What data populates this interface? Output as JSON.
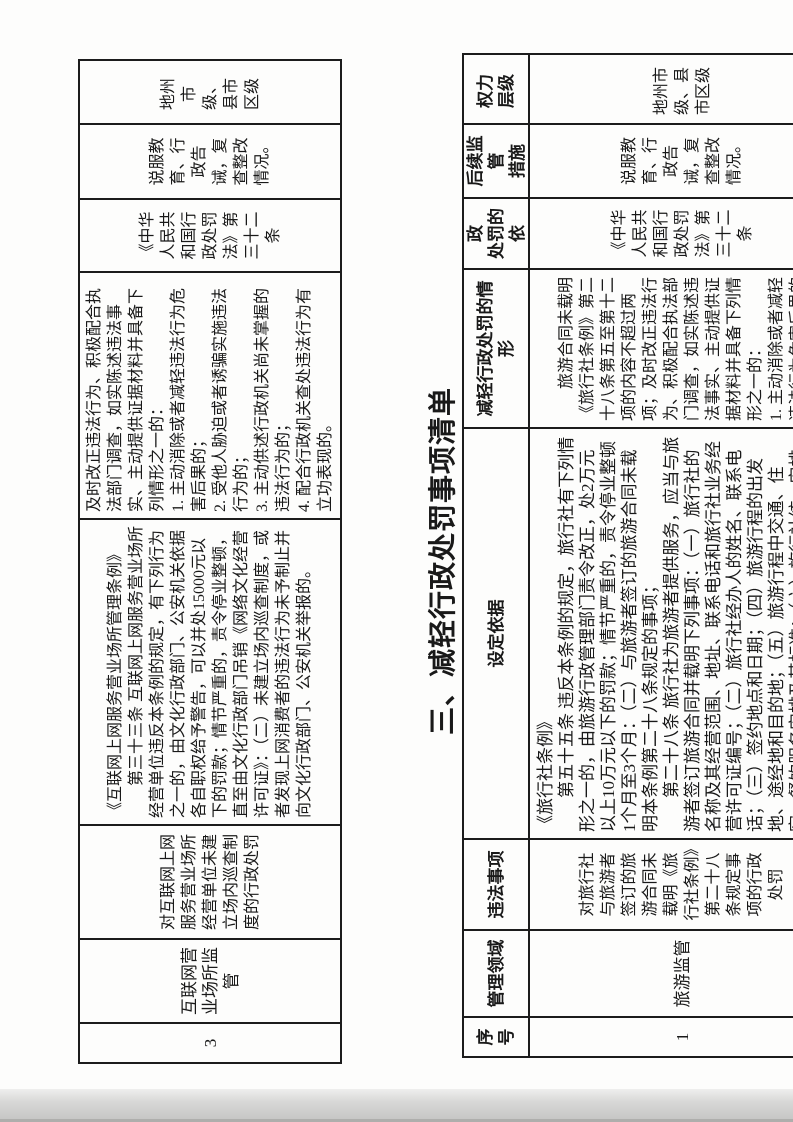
{
  "title": "三、减轻行政处罚事项清单",
  "table2_headers": {
    "num": "序号",
    "field": "管理领域",
    "item": "违法事项",
    "basis": "设定依据",
    "mitigating": "减轻行政处罚的情形",
    "legal_basis": "减轻行政\n处罚的依\n据",
    "followup": "后续监管\n措施",
    "authority": "权力\n层级"
  },
  "table1_row": {
    "num": "3",
    "field": "互联网营业场所监管",
    "item": "对互联网上网服务营业场所经营单位未建立场内巡查制度的行政处罚",
    "basis": "《互联网上网服务营业场所管理条例》\n　　第三十三条 互联网上网服务营业场所经营单位违反本条例的规定，有下列行为之一的，由文化行政部门、公安机关依据各自职权给予警告，可以并处15000元以下的罚款；情节严重的，责令停业整顿，直至由文化行政部门吊销《网络文化经营许可证》：（二）未建立场内巡查制度，或者发现上网消费者的违法行为未予制止并向文化行政部门、公安机关举报的。",
    "mitigating": "及时改正违法行为、积极配合执法部门调查，如实陈述违法事实、主动提供证据材料并具备下列情形之一的：\n1. 主动消除或者减轻违法行为危害后果的；\n2. 受他人胁迫或者诱骗实施违法行为的；\n3. 主动供述行政机关尚未掌握的违法行为的；\n4. 配合行政机关查处违法行为有立功表现的。",
    "legal_basis": "《中华人民共和国行政处罚法》第三十二条",
    "followup": "说服教育、行政告诫，复查整改情况。",
    "authority": "地州市级、县市区级"
  },
  "table2_row": {
    "num": "1",
    "field": "旅游监管",
    "item": "对旅行社与旅游者签订的旅游合同未载明《旅行社条例》第二十八条规定事项的行政处罚",
    "basis": "《旅行社条例》\n　　第五十五条 违反本条例的规定，旅行社有下列情形之一的，由旅游行政管理部门责令改正，处2万元以上10万元以下的罚款；情节严重的，责令停业整顿1个月至3个月：（二）与旅游者签订的旅游合同未载明本条例第二十八条规定的事项；\n　　第二十八条 旅行社为旅游者提供服务，应当与旅游者签订旅游合同并载明下列事项：（一）旅行社的名称及其经营范围、地址、联系电话和旅行社业务经营许可证编号；（二）旅行社经办人的姓名、联系电话；（三）签约地点和日期；（四）旅游行程的出发地、途经地和目的地；（五）旅游行程中交通、住宿、餐饮服务安排及其标准；（六）旅行社统一安排的",
    "mitigating": "　　旅游合同未载明《旅行社条例》第二十八条第五至第十二项的内容不超过两项；及时改正违法行为、积极配合执法部门调查，如实陈述违法事实、主动提供证据材料并具备下列情形之一的：\n1. 主动消除或者减轻违法行为危害后果的",
    "legal_basis": "《中华人民共和国行政处罚法》第三十二条",
    "followup": "说服教育、行政告诫，复查整改情况。",
    "authority": "地州市级、县市区级"
  }
}
